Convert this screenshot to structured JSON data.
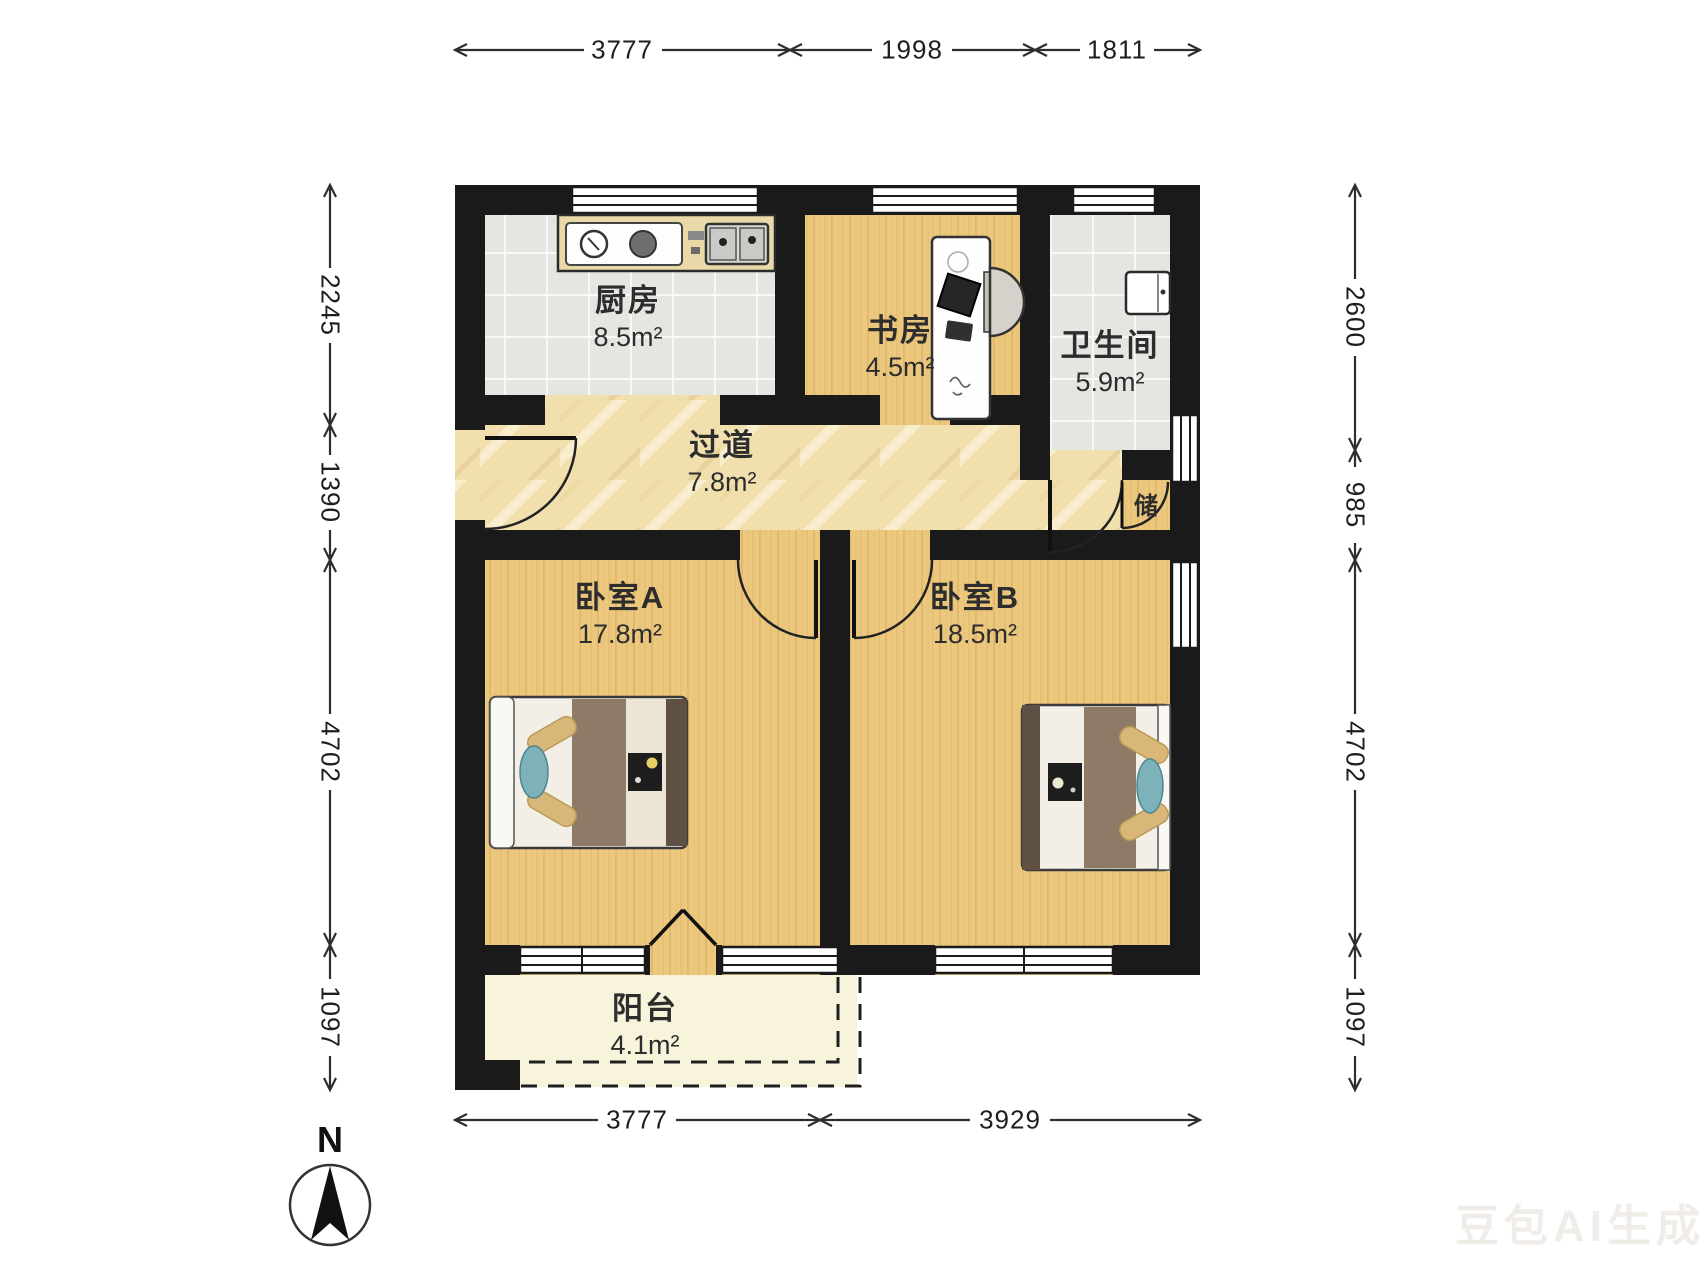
{
  "plan": {
    "rooms": [
      {
        "id": "kitchen",
        "name": "厨房",
        "area": "8.5m²"
      },
      {
        "id": "study",
        "name": "书房",
        "area": "4.5m²"
      },
      {
        "id": "bathroom",
        "name": "卫生间",
        "area": "5.9m²"
      },
      {
        "id": "hallway",
        "name": "过道",
        "area": "7.8m²"
      },
      {
        "id": "bedroom-a",
        "name": "卧室A",
        "area": "17.8m²"
      },
      {
        "id": "bedroom-b",
        "name": "卧室B",
        "area": "18.5m²"
      },
      {
        "id": "balcony",
        "name": "阳台",
        "area": "4.1m²"
      },
      {
        "id": "storage",
        "name": "储",
        "area": ""
      }
    ],
    "dimensions": {
      "top": [
        "3777",
        "1998",
        "1811"
      ],
      "left": [
        "2245",
        "1390",
        "4702",
        "1097"
      ],
      "right": [
        "2600",
        "985",
        "4702",
        "1097"
      ],
      "bottom": [
        "3777",
        "3929"
      ]
    },
    "compass": {
      "label": "N"
    },
    "watermark": "豆包AI生成",
    "colors": {
      "wall": "#1a1a1a",
      "wood": "#ebc87e",
      "tile": "#e4e6e2",
      "marble": "#f1e0ad",
      "balcony": "#f8f4dc",
      "counter": "#ead9a8",
      "blanket": "#8d7b67",
      "pillow": "#d9b778",
      "cushion": "#7eb2ba"
    }
  }
}
